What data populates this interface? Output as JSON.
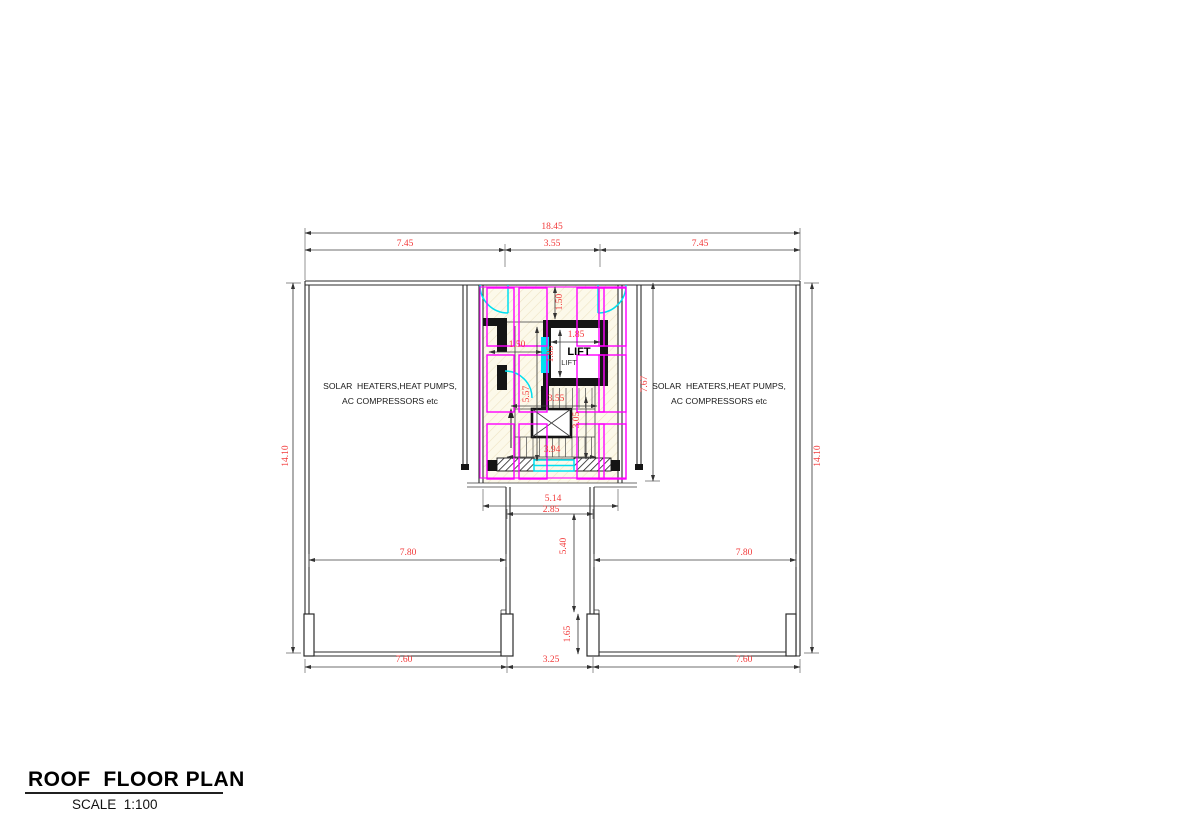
{
  "title": {
    "main": "ROOF  FLOOR PLAN",
    "scale": "SCALE  1:100"
  },
  "labels": {
    "area_left_line1": "SOLAR  HEATERS,HEAT PUMPS,",
    "area_left_line2": "AC COMPRESSORS etc",
    "area_right_line1": "SOLAR  HEATERS,HEAT PUMPS,",
    "area_right_line2": "AC COMPRESSORS etc",
    "lift_main": "LIFT",
    "lift_sub": "LIFT"
  },
  "dimensions": {
    "top_total": "18.45",
    "top_left": "7.45",
    "top_mid": "3.55",
    "top_right": "7.45",
    "left_height": "14.10",
    "right_height": "14.10",
    "core_height": "7.67",
    "core_top_setback": "1.50",
    "hall_width": "1.50",
    "lift_width": "1.85",
    "lift_depth": "1.85",
    "stair_hall_depth": "5.57",
    "stair_width": "3.55",
    "flight_depth": "3.05",
    "stair_total_width": "3.94",
    "core_width": "5.14",
    "tower_inner_width": "2.85",
    "tower_height": "5.40",
    "pier_height": "1.65",
    "terrace_left": "7.80",
    "terrace_right": "7.80",
    "bottom_left": "7.60",
    "bottom_center": "3.25",
    "bottom_right": "7.60"
  },
  "colors": {
    "dim_text": "#f23a3a",
    "panel": "#ff00ff",
    "door": "#00dff0",
    "wall": "#2b2b2b"
  }
}
